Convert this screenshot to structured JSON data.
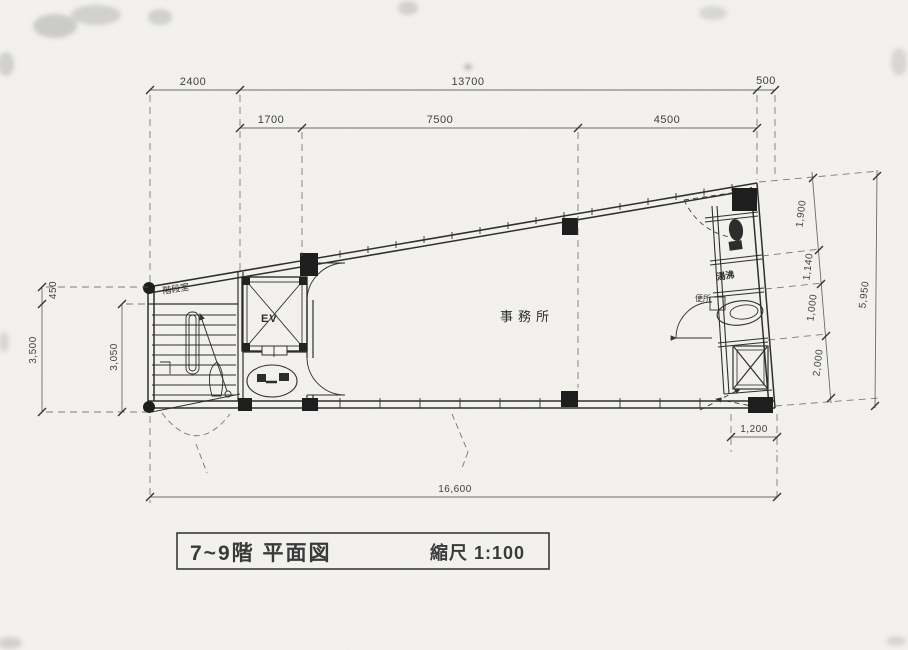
{
  "drawing": {
    "title": "7~9階 平面図",
    "scale": "縮尺 1:100"
  },
  "labels": {
    "office": "事務所",
    "stair": "階段室",
    "elevator": "EV",
    "kitchenette": "湯沸",
    "toilet": "便所"
  },
  "dims": {
    "top_2400": "2400",
    "top_13700": "13700",
    "top_500": "500",
    "sub_1700": "1700",
    "sub_7500": "7500",
    "sub_4500": "4500",
    "left_450": "450",
    "left_3500": "3,500",
    "left_3050": "3,050",
    "right_1900": "1,900",
    "right_1140": "1,140",
    "right_1000": "1,000",
    "right_2000": "2,000",
    "right_5950": "5,950",
    "bottom_1200": "1,200",
    "bottom_16600": "16,600"
  }
}
